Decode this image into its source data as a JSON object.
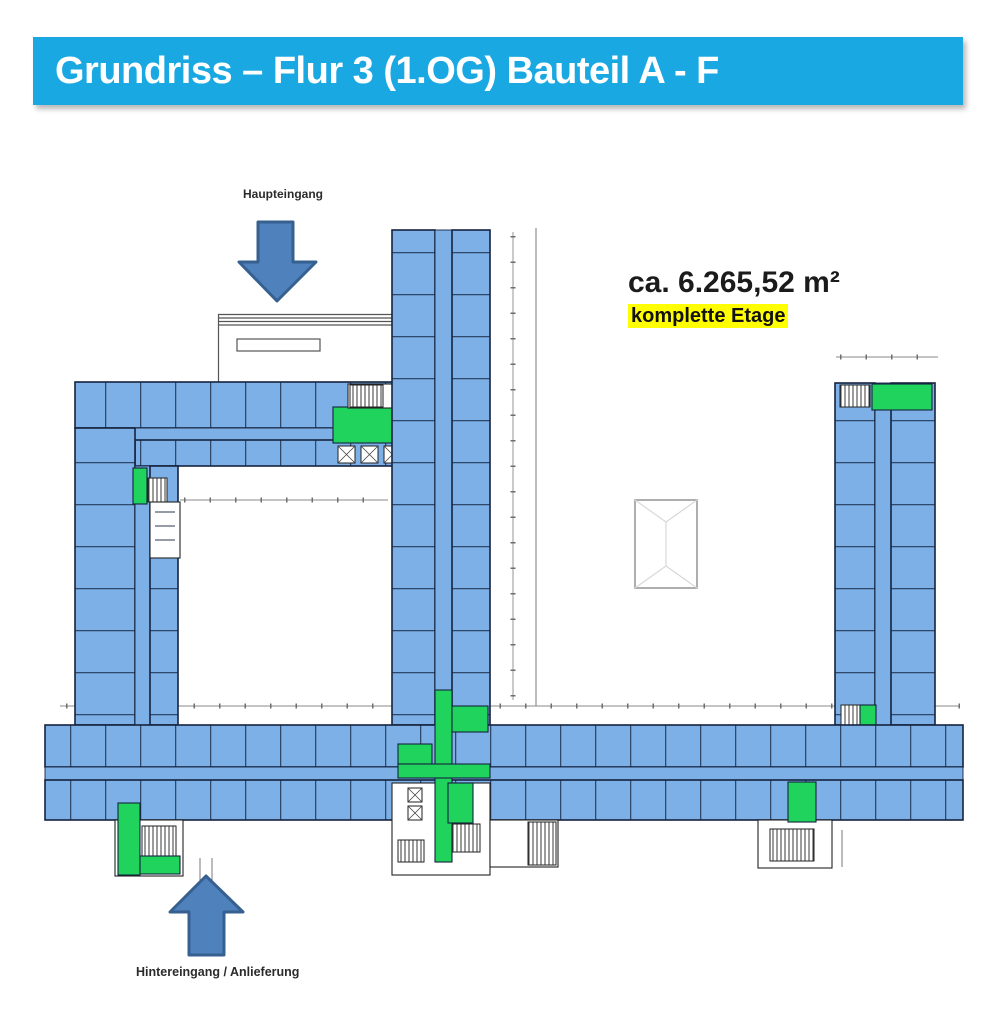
{
  "colors": {
    "header_blue": "#19A8E2",
    "room_blue": "#7DB0E6",
    "room_green": "#1FD35C",
    "wall_dark": "#15233F",
    "arrow_fill": "#4F81BD",
    "arrow_stroke": "#36608F",
    "highlight_yellow": "#FFFF00",
    "dim_gray": "#8a8a8a",
    "canopy_gray": "#555555"
  },
  "header": {
    "title": "Grundriss – Flur 3 (1.OG) Bauteil A - F"
  },
  "stats": {
    "area_value": "ca. 6.265,52 m²",
    "area_note": "komplette Etage"
  },
  "plan_labels": {
    "main_entrance": "Haupteingang",
    "rear_entrance": "Hintereingang / Anlieferung"
  },
  "icons": {
    "main_entrance_arrow": "arrow-down",
    "rear_entrance_arrow": "arrow-up"
  }
}
